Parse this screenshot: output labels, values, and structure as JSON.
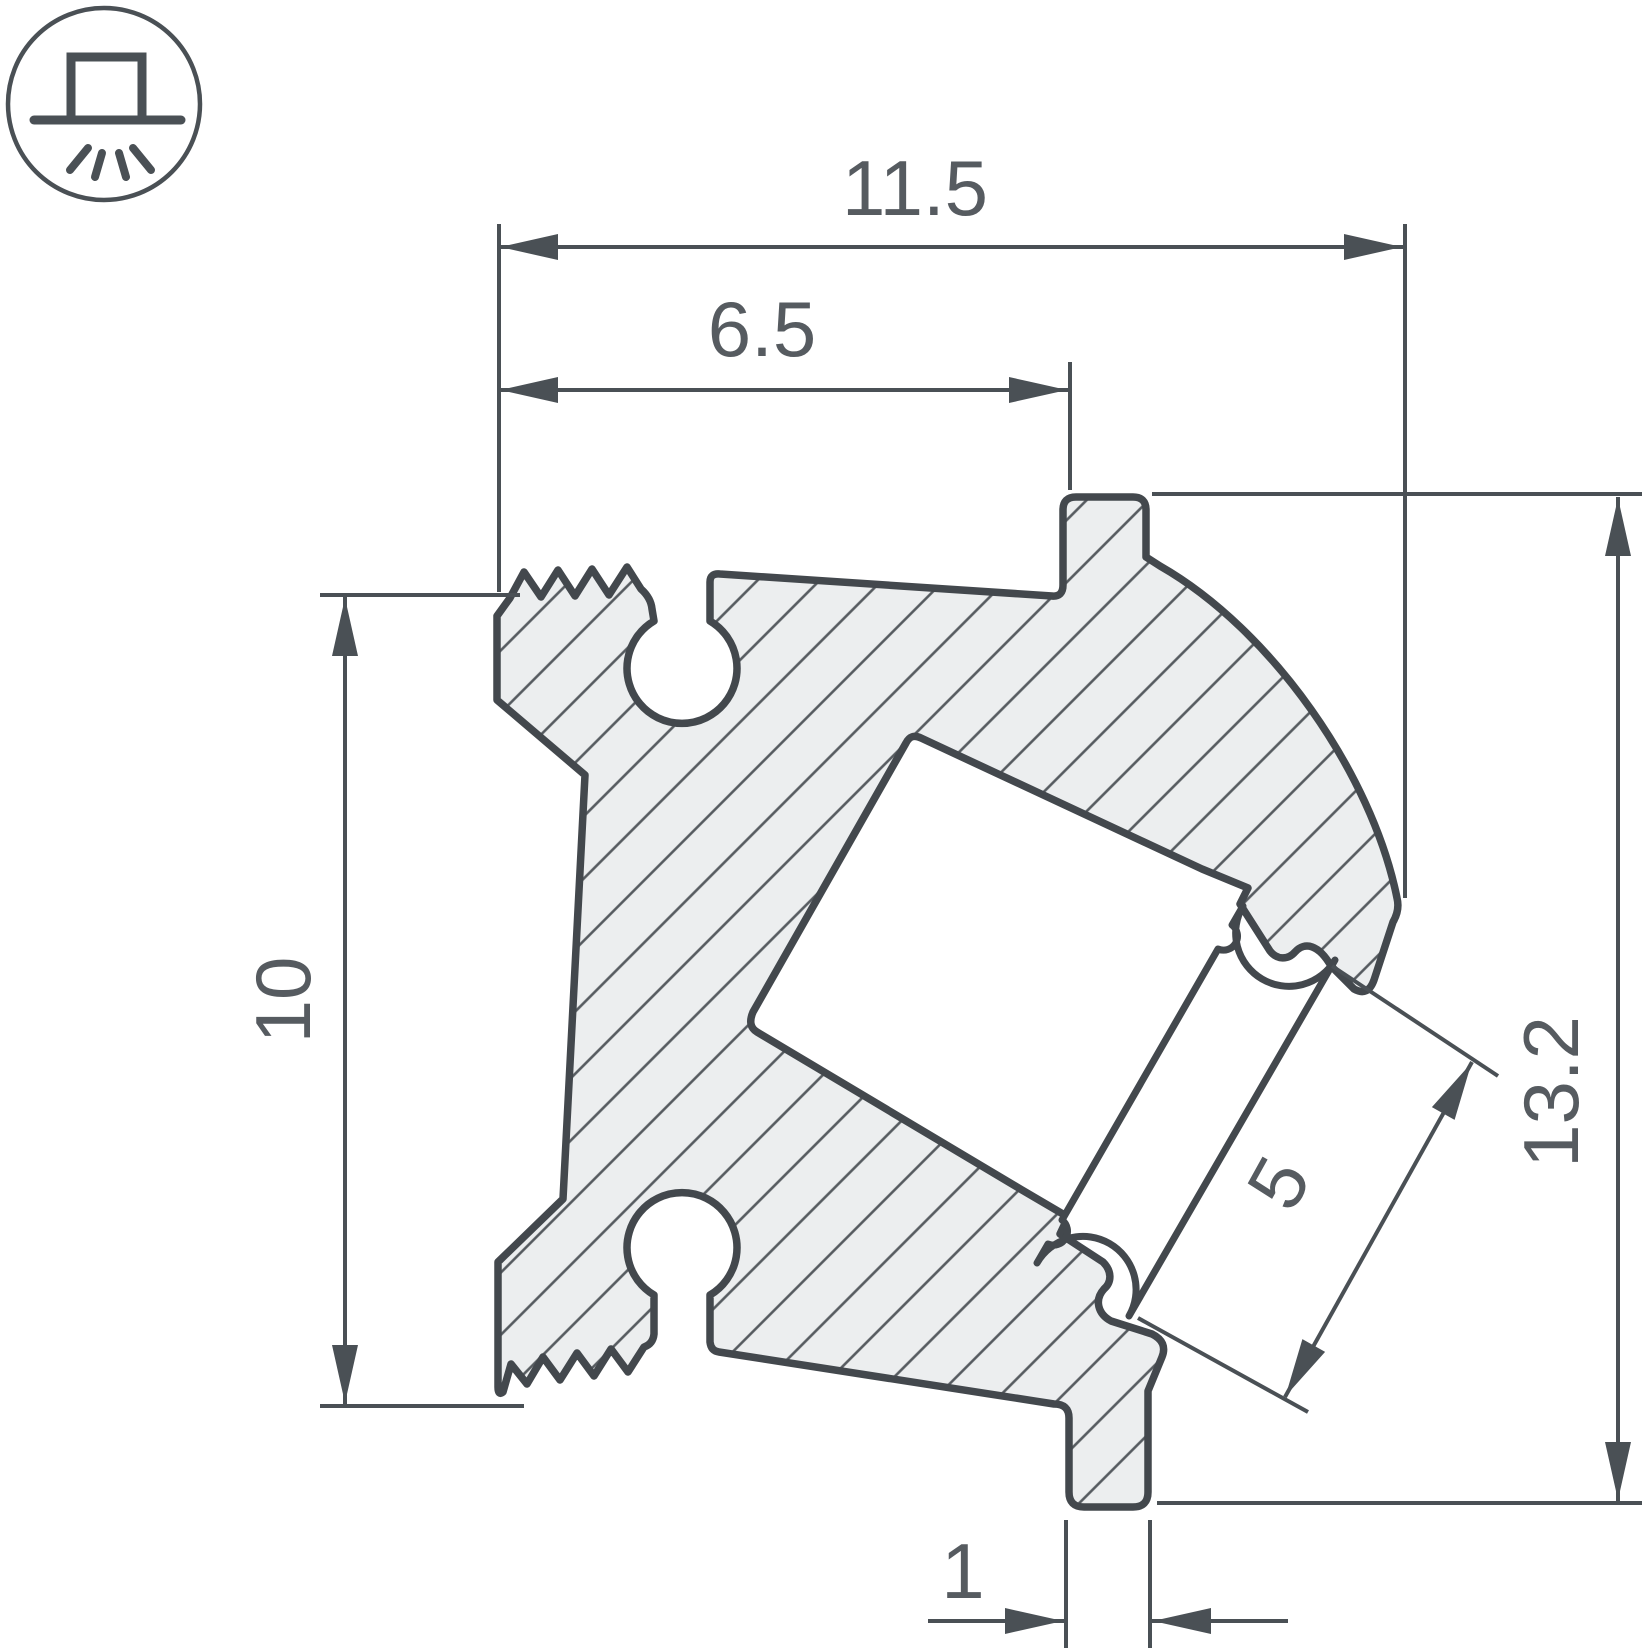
{
  "drawing": {
    "type": "technical-cross-section",
    "subject": "angled LED aluminum profile cross-section with diffuser",
    "icon": "surface-mounted-downlight-icon",
    "dimensions": {
      "overall_width": "11.5",
      "inner_width": "6.5",
      "left_height": "10",
      "overall_height": "13.2",
      "diffuser_length": "5",
      "foot_width": "1"
    },
    "colors": {
      "outline": "#43484d",
      "material_fill": "#eceeef",
      "hatch": "#565b60",
      "dimension_lines": "#4a5055",
      "text": "#565b60",
      "background": "#ffffff"
    }
  }
}
